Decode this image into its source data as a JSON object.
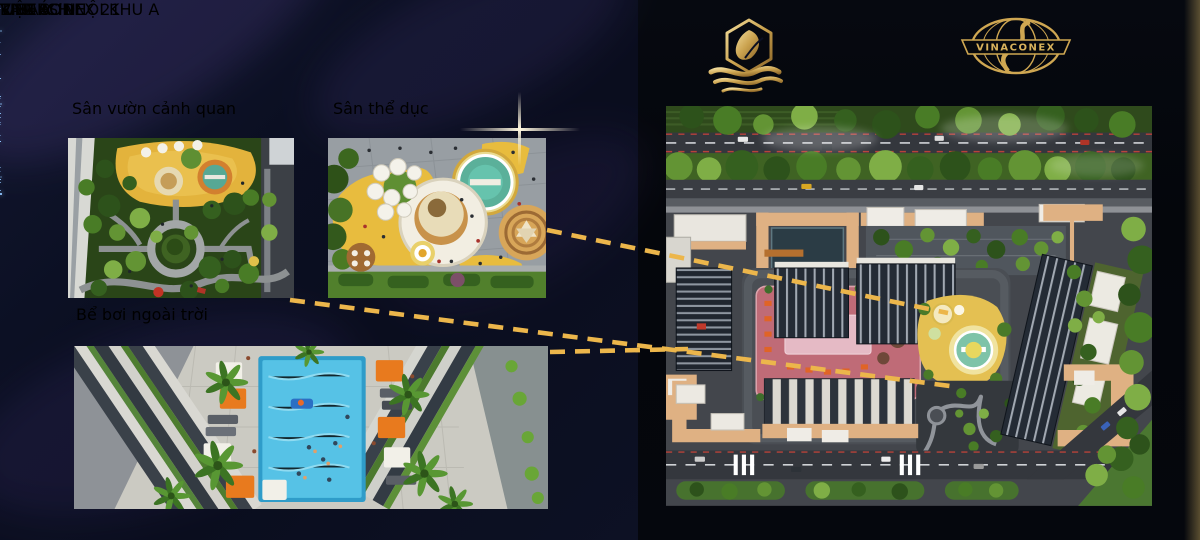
{
  "left_panel": {
    "title": "TIỆN ÍCH NỘI KHU A",
    "amenities": [
      {
        "label": "Sân vườn cảnh quan"
      },
      {
        "label": "Sân thể dục"
      },
      {
        "label": "Bể bơi ngoài trời"
      }
    ]
  },
  "right_panel": {
    "brand": {
      "name": "LAM SƠN",
      "tagline": "RIVERSIDE"
    },
    "developer": {
      "globe_banner": "VINACONEX",
      "name": "VINACONEX 21"
    },
    "map_badge": "KHU A"
  },
  "colors": {
    "gold": "#d9b052",
    "gold_bright": "#f2d88a",
    "background_left": "#0b0f22",
    "background_right": "#04060b",
    "dashed_line": "#ecb64b",
    "pool_water": "#45b4dc",
    "terrace_pink": "#bf6b77",
    "playground_yellow": "#e4c052"
  }
}
